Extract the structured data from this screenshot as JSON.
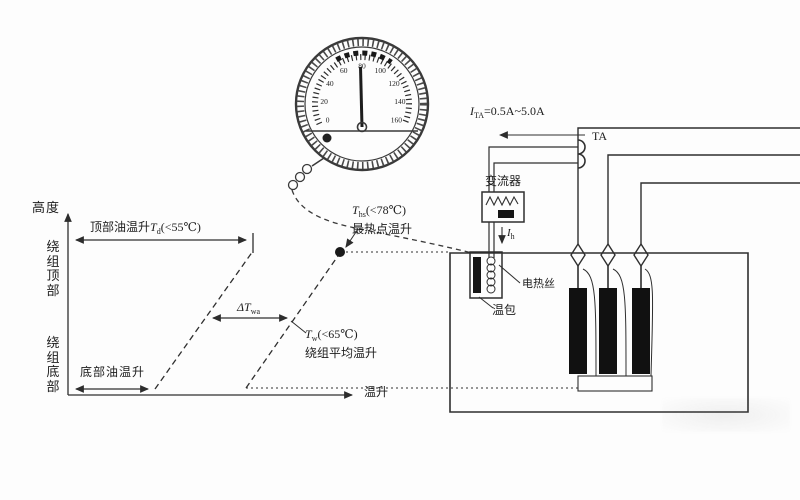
{
  "chart": {
    "y_axis_label": "高度",
    "x_axis_label": "温升",
    "winding_top_label": "绕组顶部",
    "winding_bottom_label": "绕组底部",
    "top_oil_rise": {
      "prefix": "顶部油温升",
      "sym": "T",
      "sub": "d",
      "cond": "(<55℃)"
    },
    "hotspot_rise": {
      "sym": "T",
      "sub": "hs",
      "cond": "(<78℃)",
      "name": "最热点温升"
    },
    "gradient": {
      "sym": "ΔT",
      "sub": "wa"
    },
    "avg_rise": {
      "sym": "T",
      "sub": "w",
      "cond": "(<65℃)",
      "name": "绕组平均温升"
    },
    "bottom_oil_label": "底部油温升"
  },
  "gauge": {
    "scale": [
      "0",
      "20",
      "40",
      "60",
      "80",
      "100",
      "120",
      "140",
      "160"
    ]
  },
  "circuit": {
    "ta_current": {
      "sym": "I",
      "sub": "TA",
      "value": "=0.5A~5.0A"
    },
    "ta_label": "TA",
    "converter_label": "变流器",
    "heater_current": {
      "sym": "I",
      "sub": "h"
    },
    "heater_wire_label": "电热丝",
    "bulb_label": "温包"
  }
}
